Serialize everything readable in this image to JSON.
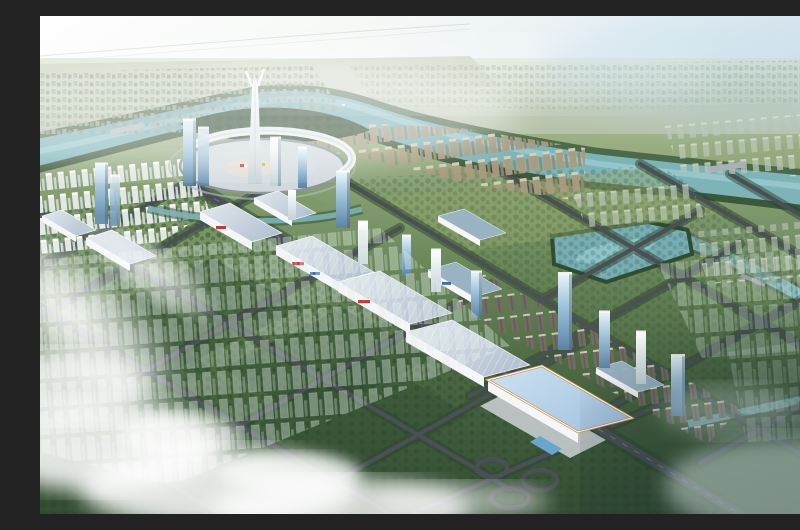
{
  "scene": {
    "description": "Aerial bird's-eye architectural rendering of a planned riverside city district: a circular landmark plaza with a twin-spire tower inside a river bend, a diagonal axis of white exhibition halls and glass towers, residential slab blocks, a diamond road grid over green parcels, translucent planned buildings, clouds at lower left and haze at lower right",
    "elements": [
      {
        "name": "sky-haze",
        "label": "hazy white-to-blue sky"
      },
      {
        "name": "distant-sprawl",
        "label": "far low-rise city sprawl"
      },
      {
        "name": "main-river",
        "label": "teal river winding around the central plaza"
      },
      {
        "name": "central-plaza",
        "label": "circular plaza with white canopy ring"
      },
      {
        "name": "landmark-tower",
        "label": "white twin-spire landmark tower"
      },
      {
        "name": "exhibition-axis",
        "label": "diagonal chain of white trade halls with blue roofs"
      },
      {
        "name": "convention-center",
        "label": "large hall with pale blue roof and tan trim"
      },
      {
        "name": "glass-towers",
        "label": "blue glass high-rises along the axis"
      },
      {
        "name": "residential-rows",
        "label": "tan and gray residential slab rows"
      },
      {
        "name": "road-grid",
        "label": "tree-lined diagonal road grid with cloverleaf interchange"
      },
      {
        "name": "ghost-buildings",
        "label": "translucent future-phase towers"
      },
      {
        "name": "clouds",
        "label": "white clouds and light flare lower left"
      },
      {
        "name": "dark-mist-corner",
        "label": "dark misty fields lower right"
      }
    ]
  },
  "colors": {
    "sky1": "#ffffff",
    "sky2": "#eef3ee",
    "sky3": "#cfe2ec",
    "sky4": "#b4d1e1",
    "far1": "#dde5d4",
    "far2": "#aab896",
    "ground1": "#9db184",
    "ground2": "#6d8a5c",
    "ground3": "#47633f",
    "ground4": "#324b33",
    "river": "#7db4b8",
    "river_hi": "#a8d6da",
    "lake": "#76aeb4",
    "forest": "#2f4c31",
    "forest2": "#3a5a3c",
    "road": "#4a5056",
    "road_halo": "#2c452c",
    "plaza": "#d2dade",
    "canopy": "#f2f6f7",
    "glass1": "#e9f3f8",
    "glass2": "#9cc0d8",
    "glass3": "#5b84a4",
    "white_tower1": "#ffffff",
    "white_tower2": "#c3d2d6",
    "tan_hi": "#d9d0b6",
    "tan_lo": "#a89c80",
    "slab_gray": "#b9c6b4",
    "slab_brown": "#756c5d",
    "hall_wall": "#f4f6f8",
    "hall_roof1": "#e3eaf0",
    "hall_roof2": "#9db6c8",
    "accent_red": "#c23b3b",
    "accent_blue": "#3a6ab0",
    "accent_yellow": "#d8b23a",
    "conv_roof1": "#cfe2f2",
    "conv_roof2": "#a4c4e0",
    "conv_trim": "#c9995c",
    "city_far": "#a3b09c",
    "cloud": "#ffffff",
    "mist": "#d7e4e0"
  }
}
